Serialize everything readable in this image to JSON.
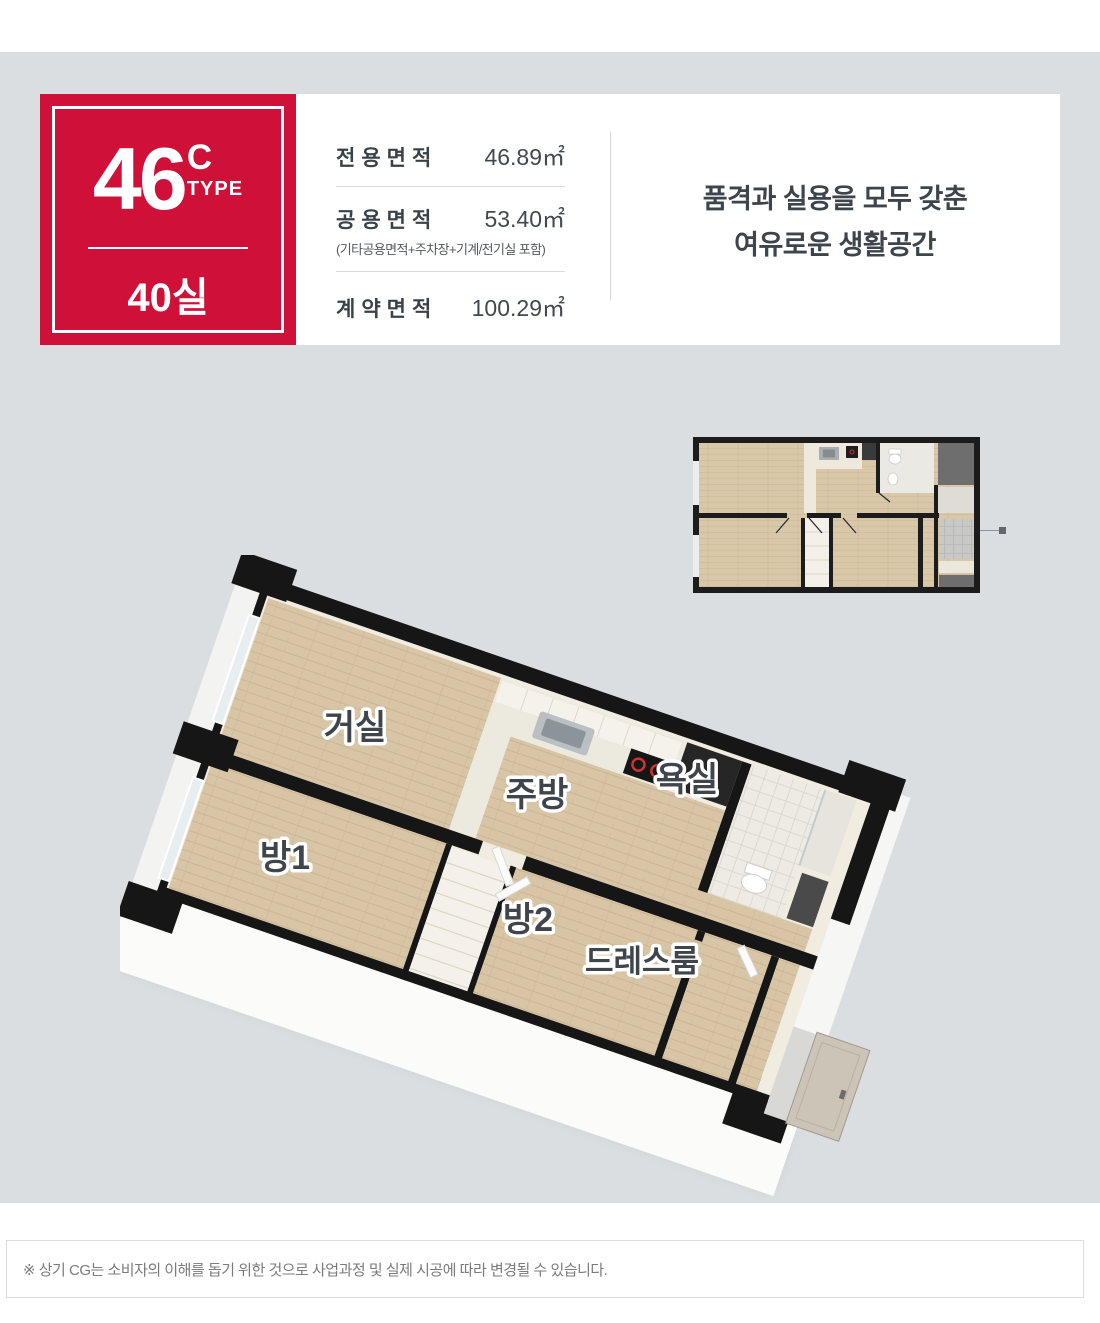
{
  "badge": {
    "number": "46",
    "suffix": "C",
    "type_label": "TYPE",
    "unit_count": "40실",
    "color": "#cf1038"
  },
  "areas": {
    "rows": [
      {
        "label": "전용면적",
        "value": "46.89㎡"
      },
      {
        "label": "공용면적",
        "value": "53.40㎡",
        "note": "(기타공용면적+주차장+기계/전기실 포함)"
      },
      {
        "label": "계약면적",
        "value": "100.29㎡"
      }
    ]
  },
  "tagline": {
    "line1": "품격과 실용을 모두 갖춘",
    "line2": "여유로운 생활공간"
  },
  "plan": {
    "rooms": {
      "living": "거실",
      "kitchen": "주방",
      "bath": "욕실",
      "room1": "방1",
      "room2": "방2",
      "dressroom": "드레스룸"
    }
  },
  "disclaimer": {
    "text": "※ 상기 CG는 소비자의 이해를 돕기 위한 것으로 사업과정 및 실제 시공에 따라 변경될 수 있습니다."
  },
  "colors": {
    "accent_red": "#cf1038",
    "section_bg": "#dbdee0",
    "wood": "#d8c5a6",
    "wall_black": "#1a1a1a",
    "label_text": "#3f454b"
  }
}
